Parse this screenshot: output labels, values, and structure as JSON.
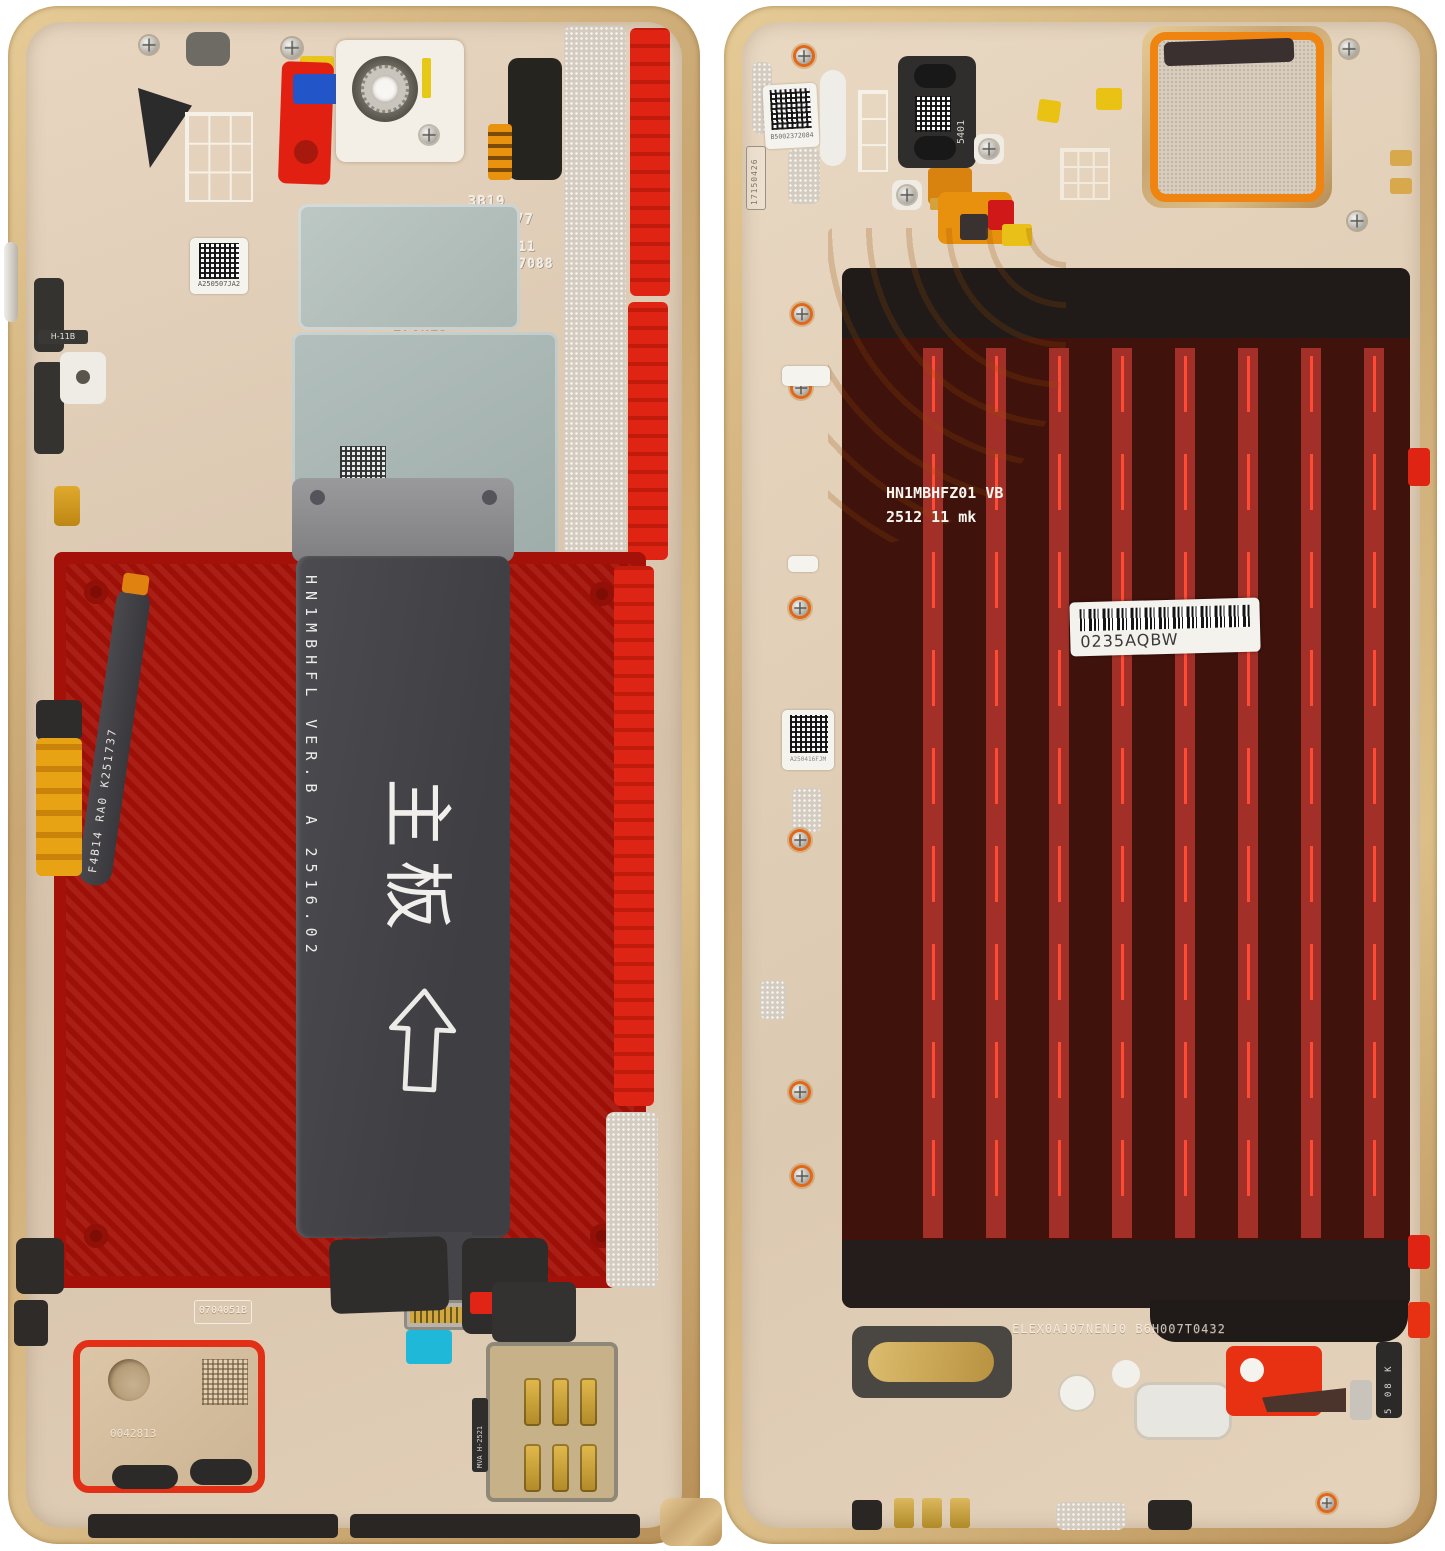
{
  "scene": {
    "type": "photograph",
    "subject": "Disassembled foldable smartphone - two internal halves: mainboard flex, battery adhesive bay, display back panel with pull strips",
    "background_color": "#ffffff"
  },
  "palette": {
    "frame_gold": "#c9a672",
    "inner_metal": "#ddc9b2",
    "adhesive_red": "#cf1b0e",
    "panel_maroon": "#40120c",
    "stripe_red": "#a33028",
    "stripe_dash": "#ff4a34",
    "flex_gray": "#47474b",
    "flex_orange": "#e8910f",
    "gasket_orange": "#ef8410",
    "sticker_blue": "#2255c8",
    "sticker_cyan": "#20b8d8",
    "label_white": "#f4f2ed"
  },
  "left_half": {
    "codes": {
      "qr_label_top": "A250507JA2",
      "etch_block1_line1": "3B19",
      "etch_block1_line2": "0457077",
      "etch_block2_line1": "17/11",
      "etch_block2_line2": "0457088",
      "etch_small": "007",
      "etch_block3_line1": "7230416",
      "etch_block3_line2": "17VN2D",
      "side_button_flex": "H-11B",
      "battery_flex": "F4B14 RA0  K251737",
      "mainboard_flex": "HN1MBHFL VER.B  A 2516.02",
      "mainboard_flex_cn": "主板",
      "speaker_stamp": "0704051B",
      "speaker_etch": "0042813",
      "sim_flex": "MVA H-2521"
    }
  },
  "right_half": {
    "codes": {
      "qr_label_top": "B5002372084",
      "frame_stamp": "17150426",
      "earpiece_code": "5401",
      "display_flex_line1": "HN1MBHFZ01 VB",
      "display_flex_line2": "2512 11  mk",
      "barcode_text": "0235AQBW",
      "qr_label_mid": "A250416FJM",
      "frame_etch_bottom": "ELEX0AJ07NENJ0 B6H007T0432",
      "corner_strip": "5 08 K"
    },
    "adhesive_stripe_count": 8
  }
}
